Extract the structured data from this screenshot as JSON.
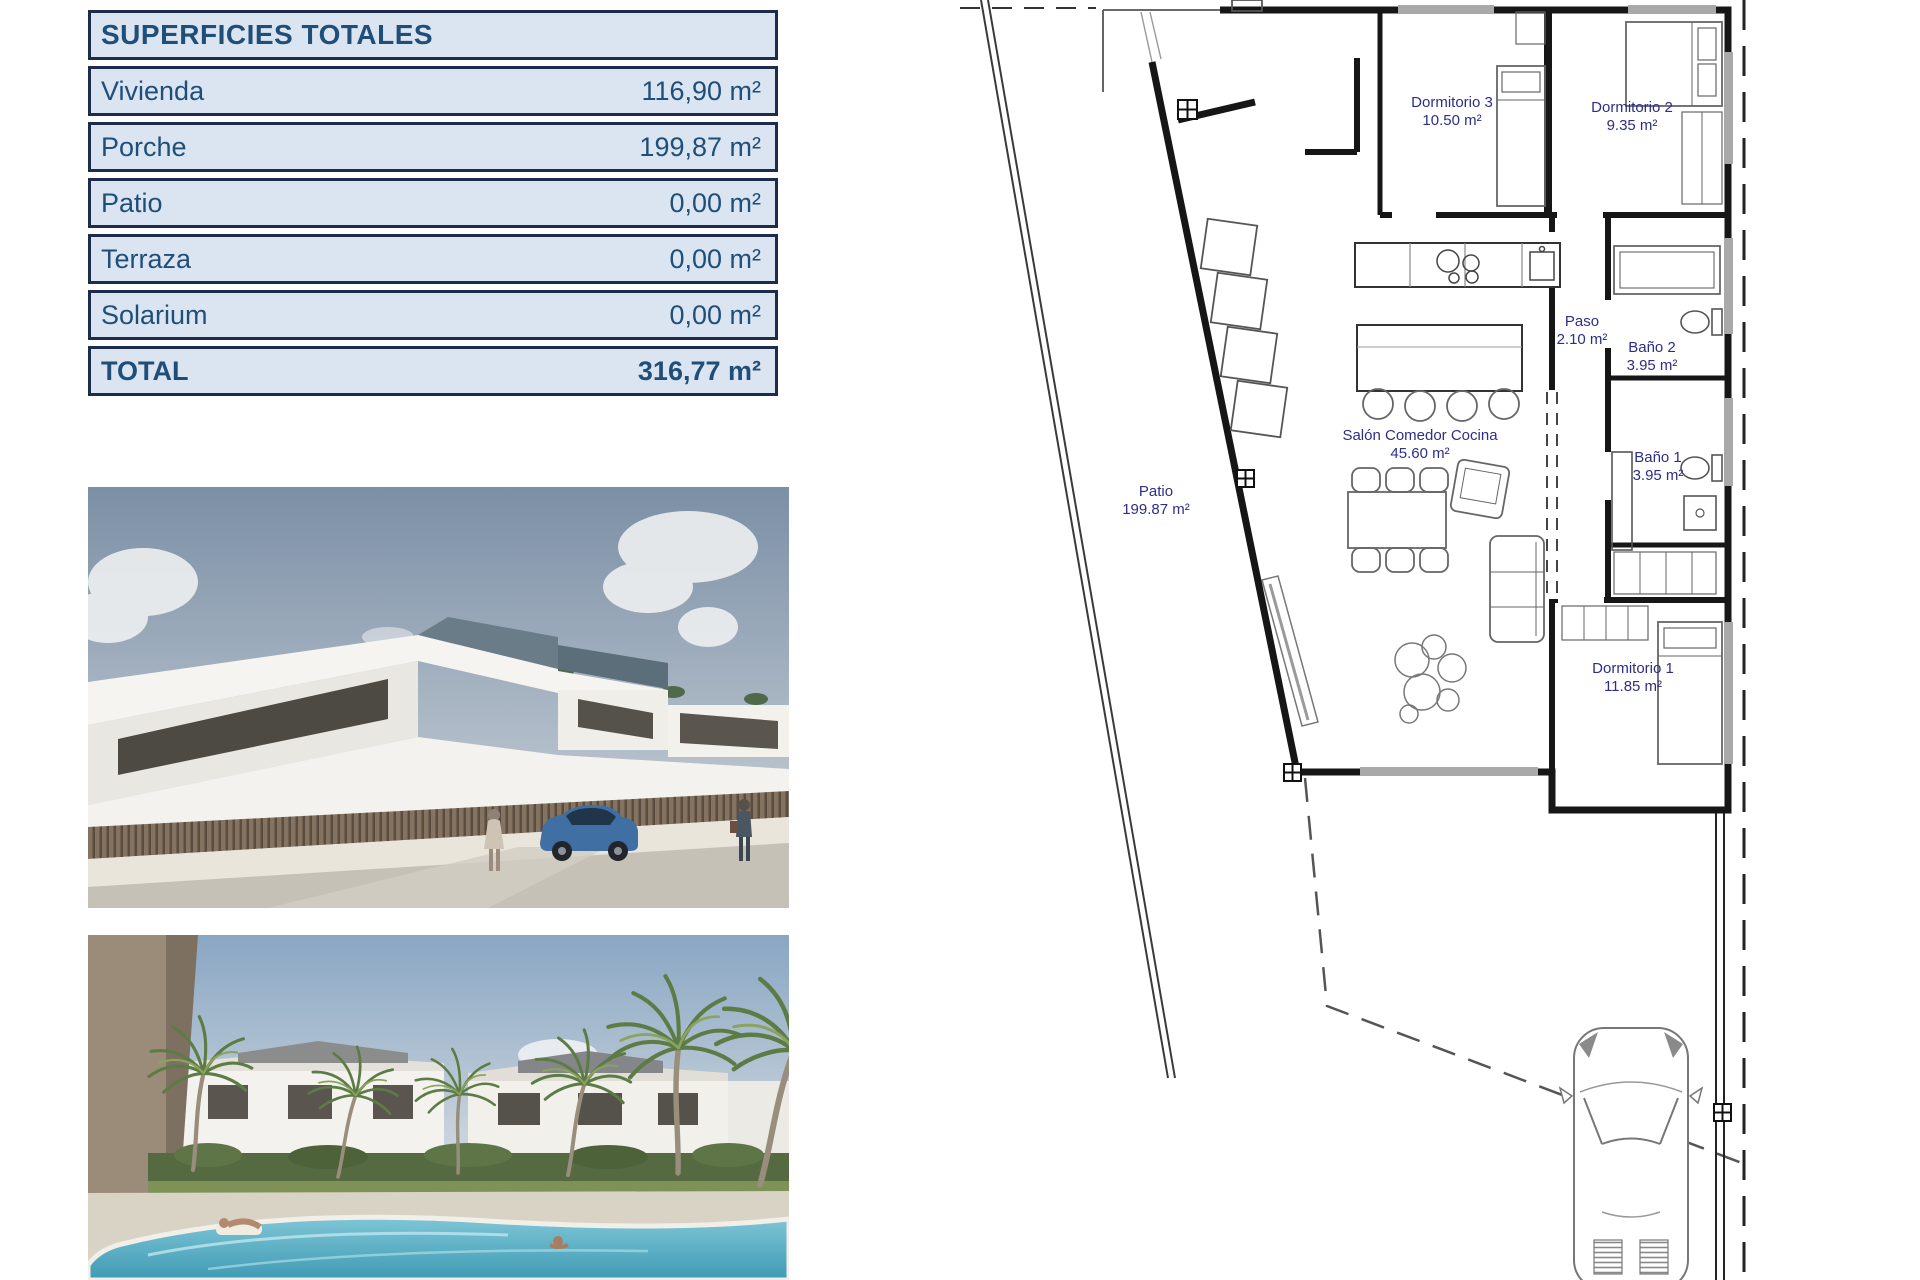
{
  "table": {
    "title": "SUPERFICIES TOTALES",
    "rows": [
      {
        "label": "Vivienda",
        "value": "116,90 m²"
      },
      {
        "label": "Porche",
        "value": "199,87 m²"
      },
      {
        "label": "Patio",
        "value": "0,00 m²"
      },
      {
        "label": "Terraza",
        "value": "0,00 m²"
      },
      {
        "label": "Solarium",
        "value": "0,00 m²"
      }
    ],
    "total": {
      "label": "TOTAL",
      "value": "316,77 m²"
    }
  },
  "plan": {
    "rooms": [
      {
        "name": "Dormitorio 3",
        "area": "10.50 m²"
      },
      {
        "name": "Dormitorio 2",
        "area": "9.35 m²"
      },
      {
        "name": "Paso",
        "area": "2.10 m²"
      },
      {
        "name": "Baño 2",
        "area": "3.95 m²"
      },
      {
        "name": "Baño 1",
        "area": "3.95 m²"
      },
      {
        "name": "Salón Comedor Cocina",
        "area": "45.60 m²"
      },
      {
        "name": "Patio",
        "area": "199.87 m²"
      },
      {
        "name": "Dormitorio 1",
        "area": "11.85 m²"
      }
    ]
  },
  "colors": {
    "table_background": "#dbe5f1",
    "table_text": "#1f4e79",
    "table_border": "#1d2c4d",
    "plan_label": "#2d2e87"
  }
}
